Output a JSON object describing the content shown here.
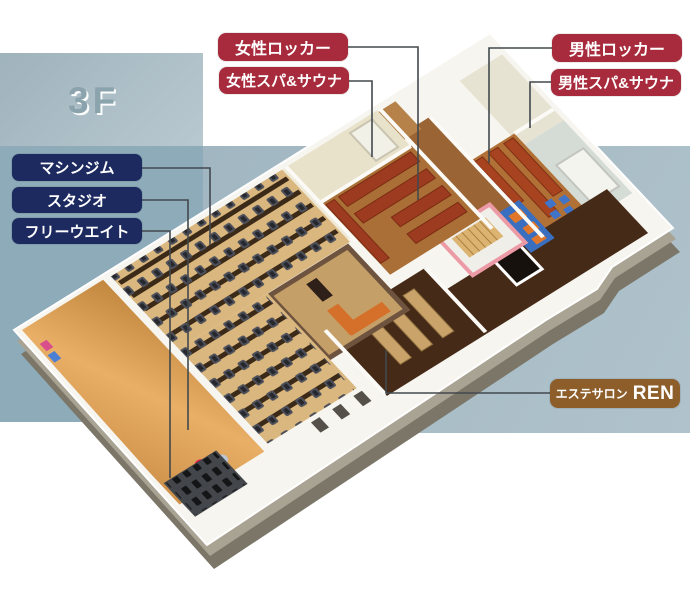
{
  "floor_indicator": "3F",
  "colors": {
    "callout_maroon": "#a72b3c",
    "callout_navy": "#1c2a60",
    "callout_brown": "#8d5e2a",
    "bg_panel_top_left": "#a9bcc5",
    "bg_panel_left": "#8dabb8",
    "bg_panel_main": "#a7bcc6",
    "floor_indicator_text": "#8ba3ad",
    "leader_line": "#42494d"
  },
  "callouts": {
    "women_locker": {
      "text": "女性ロッカー"
    },
    "women_spa": {
      "text": "女性スパ&サウナ"
    },
    "men_locker": {
      "text": "男性ロッカー"
    },
    "men_spa": {
      "text": "男性スパ&サウナ"
    },
    "machine_gym": {
      "text": "マシンジム"
    },
    "studio": {
      "text": "スタジオ"
    },
    "free_weight": {
      "text": "フリーウエイト"
    },
    "esthe_salon": {
      "text_small": "エステサロン",
      "text_large": "REN"
    }
  }
}
